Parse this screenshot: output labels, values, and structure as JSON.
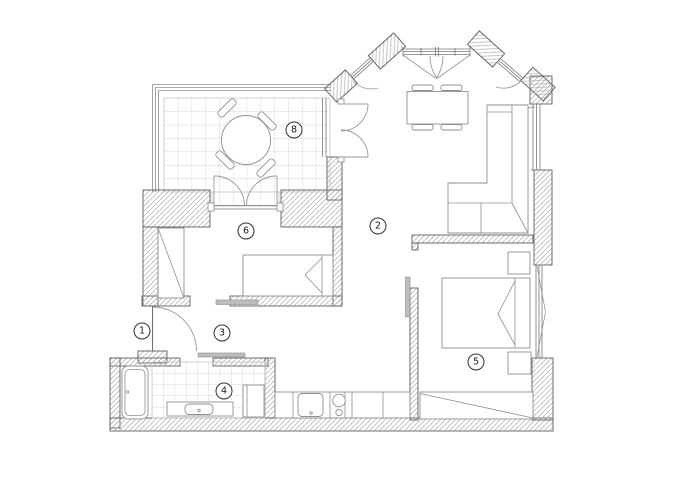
{
  "plan": {
    "title": "apartment-floor-plan",
    "colors": {
      "background": "#ffffff",
      "wall_line": "#5f5f5f",
      "hatch": "#aaaaaa",
      "tile": "#c9c9c9",
      "furniture": "#8f8f8f",
      "label_text": "#1a1a1a",
      "label_ring": "#2f2f2f"
    },
    "rooms": [
      {
        "label": "1",
        "x": 142,
        "y": 331
      },
      {
        "label": "2",
        "x": 378,
        "y": 226
      },
      {
        "label": "3",
        "x": 222,
        "y": 333
      },
      {
        "label": "4",
        "x": 224,
        "y": 391
      },
      {
        "label": "5",
        "x": 476,
        "y": 362
      },
      {
        "label": "6",
        "x": 246,
        "y": 231
      },
      {
        "label": "8",
        "x": 294,
        "y": 130
      }
    ]
  }
}
